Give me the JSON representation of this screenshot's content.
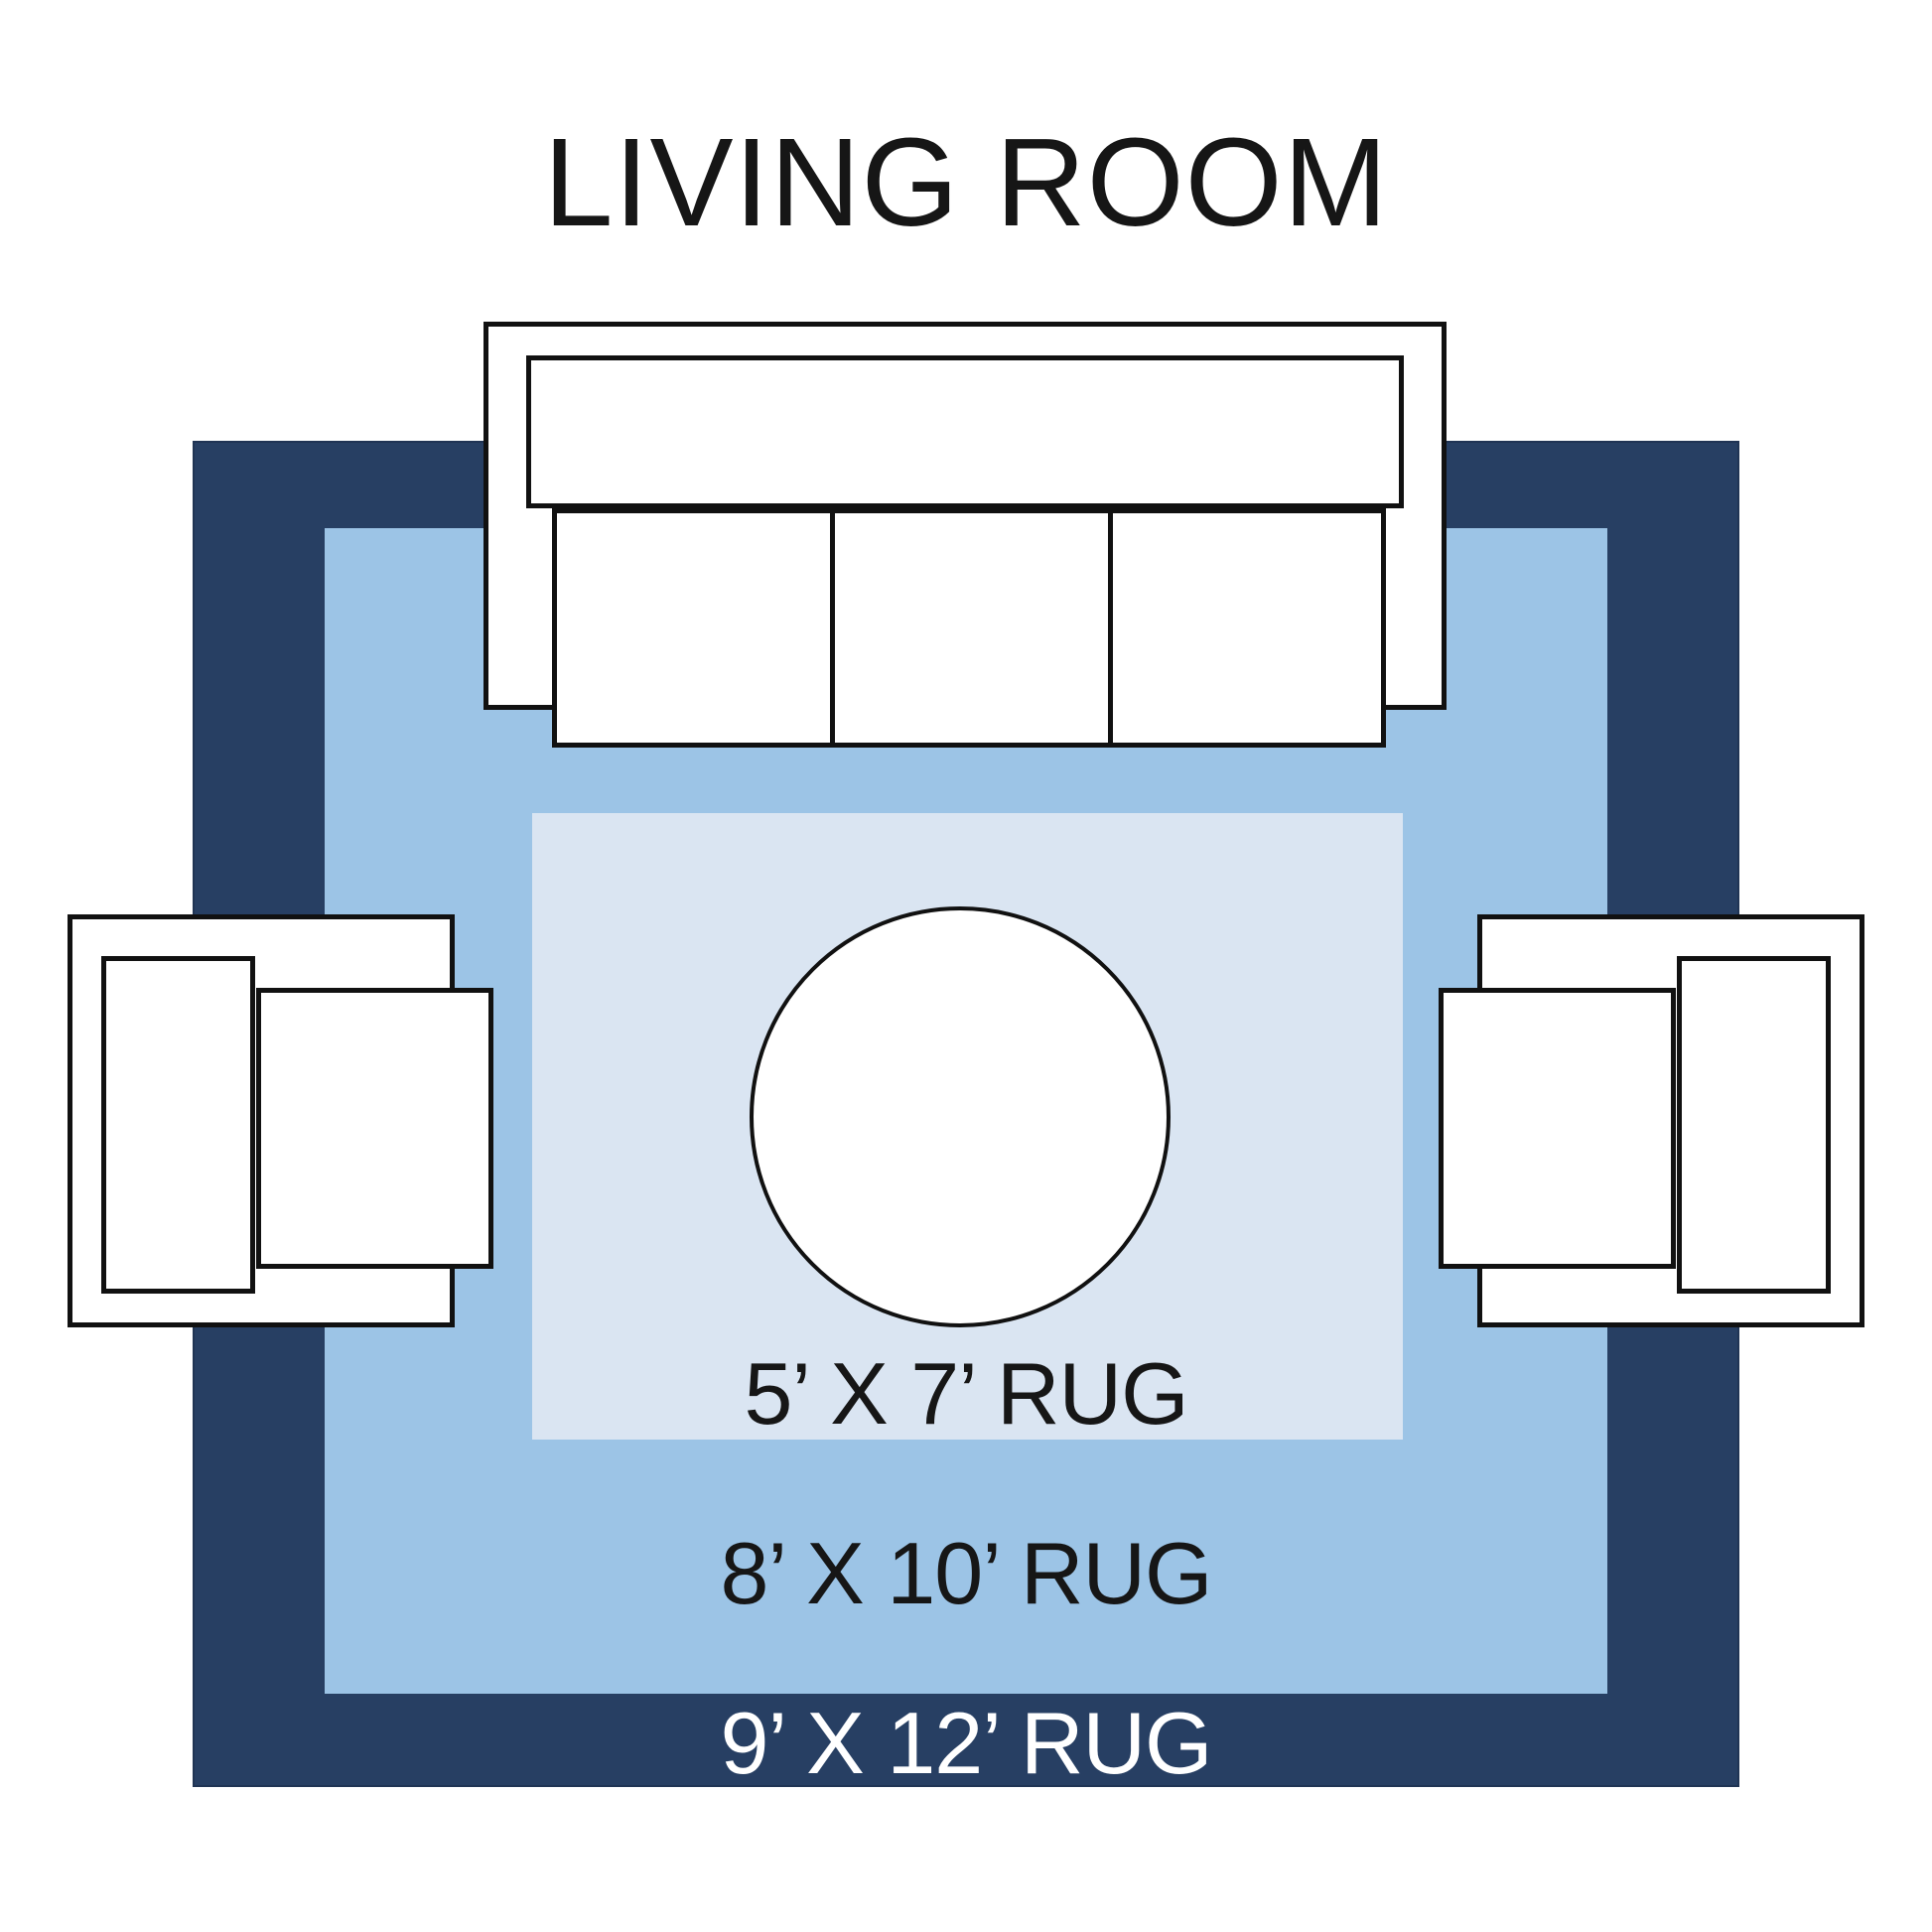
{
  "title": "LIVING ROOM",
  "colors": {
    "background": "#FFFFFF",
    "rug_9x12": "#273F63",
    "rug_8x10": "#9CC4E6",
    "rug_5x7": "#DAE5F2",
    "outline": "#111111",
    "text_dark": "#161616",
    "text_light": "#FFFFFF"
  },
  "rugs": [
    {
      "name": "rug-9x12",
      "label": "9’ X 12’ RUG",
      "color": "#273F63",
      "label_color": "#FFFFFF"
    },
    {
      "name": "rug-8x10",
      "label": "8’ X 10’ RUG",
      "color": "#9CC4E6",
      "label_color": "#161616"
    },
    {
      "name": "rug-5x7",
      "label": "5’ X 7’ RUG",
      "color": "#DAE5F2",
      "label_color": "#161616"
    }
  ],
  "furniture": [
    "sofa",
    "armchair-left",
    "armchair-right",
    "round-coffee-table"
  ]
}
